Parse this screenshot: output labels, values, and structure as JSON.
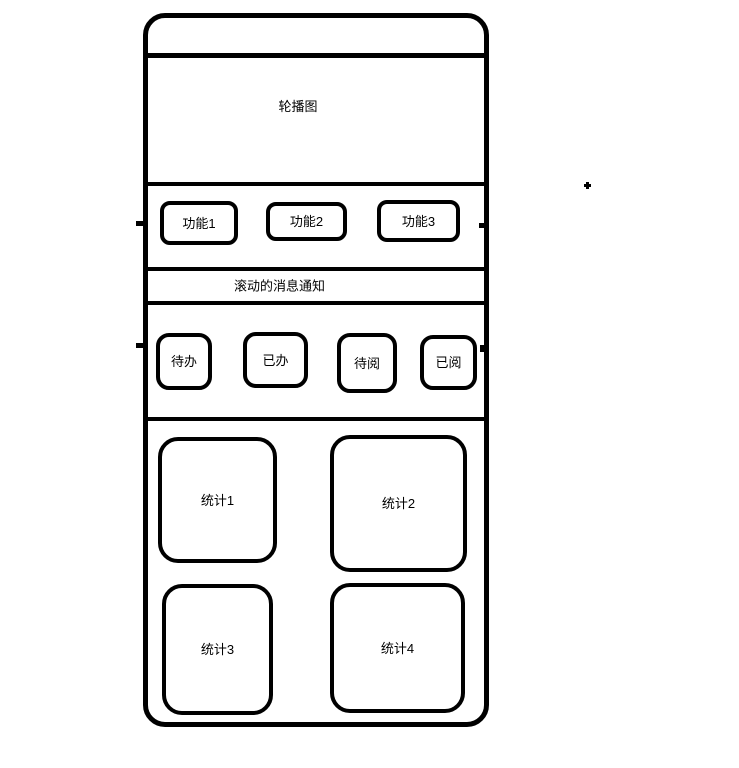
{
  "wireframe": {
    "status_bar": {},
    "carousel": {
      "label": "轮播图"
    },
    "function_row": {
      "buttons": [
        {
          "label": "功能1"
        },
        {
          "label": "功能2"
        },
        {
          "label": "功能3"
        }
      ]
    },
    "notification": {
      "label": "滚动的消息通知"
    },
    "action_row": {
      "buttons": [
        {
          "label": "待办"
        },
        {
          "label": "已办"
        },
        {
          "label": "待阅"
        },
        {
          "label": "已阅"
        }
      ]
    },
    "stats": {
      "cards": [
        {
          "label": "统计1"
        },
        {
          "label": "统计2"
        },
        {
          "label": "统计3"
        },
        {
          "label": "统计4"
        }
      ]
    }
  },
  "colors": {
    "stroke": "#000000",
    "background": "#ffffff",
    "text": "#000000"
  }
}
